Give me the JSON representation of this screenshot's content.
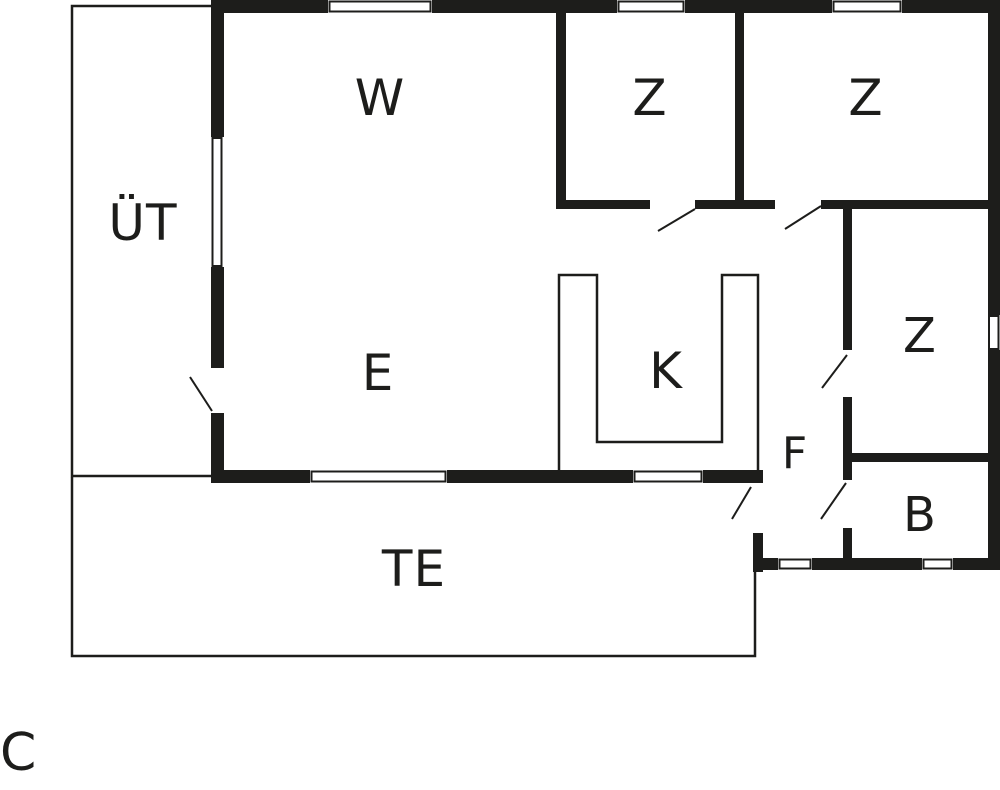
{
  "plan": {
    "background": "#ffffff",
    "wall_color": "#1d1d1b",
    "line_color": "#1d1d1b",
    "rooms": {
      "w": "W",
      "ut": "ÜT",
      "e": "E",
      "z1": "Z",
      "z2": "Z",
      "z3": "Z",
      "k": "K",
      "f": "F",
      "b": "B",
      "te": "TE"
    },
    "marker": "C"
  }
}
